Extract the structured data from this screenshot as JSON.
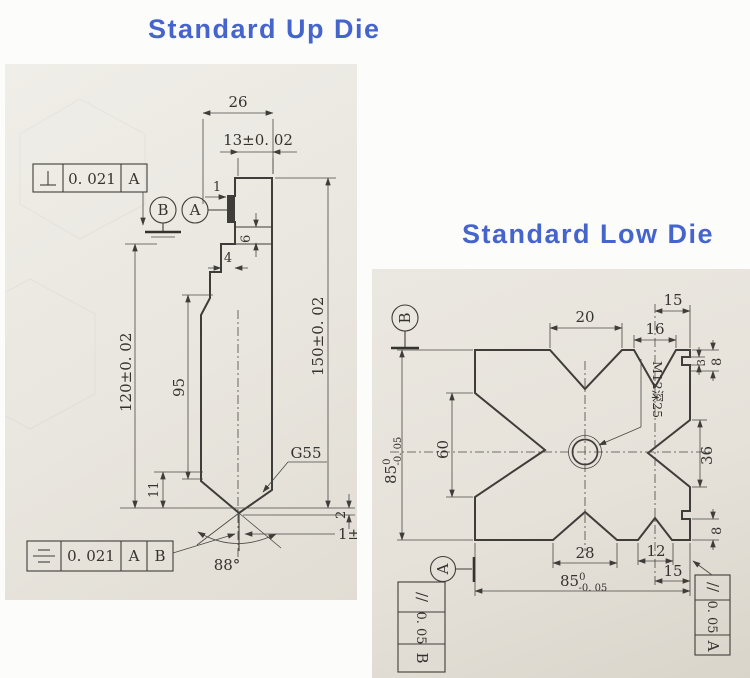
{
  "titles": {
    "up_die": "Standard Up Die",
    "low_die": "Standard Low Die"
  },
  "up_die": {
    "fcf_top": {
      "symbol_name": "perpendicularity-icon",
      "tolerance": "0. 021",
      "datum": "A"
    },
    "fcf_bottom": {
      "symbol_name": "symmetry-icon",
      "tolerance": "0. 021",
      "datum_primary": "A",
      "datum_secondary": "B"
    },
    "datum_balloons": {
      "left": "B",
      "right": "A"
    },
    "dimensions": {
      "top_width": "26",
      "tang_width": "13±0. 02",
      "ledge": "1",
      "shoulder_height": "6",
      "neck_width": "4",
      "body_height": "120±0. 02",
      "straight_length": "95",
      "overall_height": "150±0. 02",
      "tip_section": "11",
      "material_note": "G55",
      "tip_land": "2",
      "tip_width": "1±0. 02",
      "tip_angle": "88°"
    }
  },
  "low_die": {
    "datum_balloons": {
      "top": "B",
      "bottom": "A"
    },
    "fcf_left": {
      "symbol": "//",
      "symbol_name": "parallelism-icon",
      "tolerance": "0. 05",
      "datum": "B"
    },
    "fcf_right": {
      "symbol": "//",
      "symbol_name": "parallelism-icon",
      "tolerance": "0. 05",
      "datum": "A"
    },
    "dimensions": {
      "v1_width": "20",
      "v2_width": "16",
      "top_offset": "15",
      "top_corner_step": "8",
      "top_corner_step_small": "3",
      "side_v_height": "36",
      "thread_note": "M12深25",
      "height_main": "85",
      "height_tol_upper": "0",
      "height_tol_lower": "-0. 05",
      "left_v_height": "60",
      "v3_width": "28",
      "v4_width": "12",
      "bottom_offset": "15",
      "bottom_corner_step": "8",
      "width_main": "85",
      "width_tol_upper": "0",
      "width_tol_lower": "-0. 05"
    }
  }
}
